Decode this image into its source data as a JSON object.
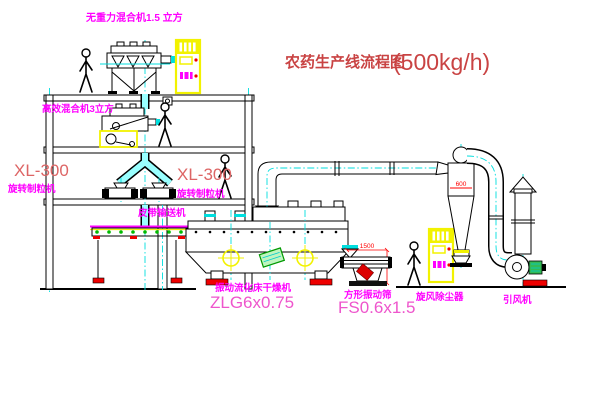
{
  "title": {
    "text": "农药生产线流程图",
    "capacity": "(500kg/h)"
  },
  "equipment": {
    "gravity_mixer": {
      "label": "无重力混合机1.5 立方"
    },
    "high_eff_mixer": {
      "label": "高效混合机3立方"
    },
    "granulator_left": {
      "model": "XL-300",
      "name": "旋转制粒机"
    },
    "granulator_mid": {
      "model": "XL-300",
      "name": "旋转制粒机"
    },
    "belt_conveyor": {
      "label": "皮带输送机"
    },
    "fluid_bed_dryer": {
      "name": "振动流化床干燥机",
      "model": "ZLG6x0.75"
    },
    "square_sieve": {
      "name": "方形振动筛",
      "model": "FS0.6x1.5",
      "dim_width": "1500"
    },
    "cyclone": {
      "label": "旋风除尘器",
      "dim": "600"
    },
    "fan": {
      "label": "引风机"
    }
  },
  "colors": {
    "label_magenta": "#ff00ff",
    "model_pink": "#ee55cc",
    "title_red": "#c94343",
    "xl_red": "#dd6565",
    "dim_red": "#ff0000",
    "cad_yellow": "#f2f200",
    "cad_cyan": "#00dede",
    "cad_green": "#00bb00"
  }
}
